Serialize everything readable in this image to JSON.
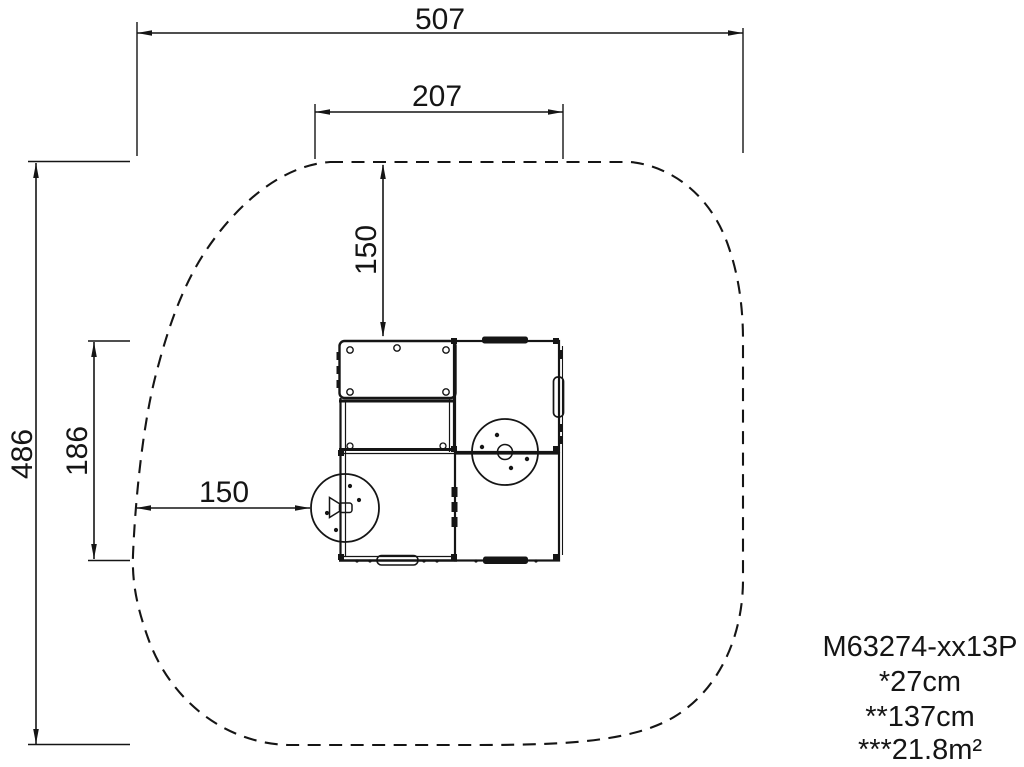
{
  "drawing": {
    "dimensions": {
      "overall_width": "507",
      "inner_width": "207",
      "overall_depth": "486",
      "equipment_depth": "186",
      "clearance_top": "150",
      "clearance_left": "150"
    },
    "product_info": {
      "model": "M63274-xx13P",
      "spec_fall_height": "*27cm",
      "spec_height": "**137cm",
      "spec_area": "***21.8m²"
    },
    "colors": {
      "ink": "#151515",
      "background": "#ffffff"
    }
  }
}
